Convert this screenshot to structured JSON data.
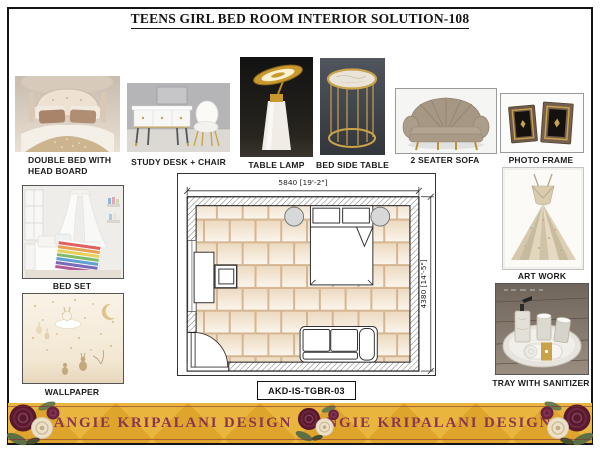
{
  "title": "TEENS GIRL BED ROOM INTERIOR SOLUTION-108",
  "products": {
    "double_bed": {
      "label_line1": "DOUBLE BED WITH",
      "label_line2": "HEAD BOARD"
    },
    "study_desk": {
      "label": "STUDY DESK + CHAIR"
    },
    "table_lamp": {
      "label": "TABLE LAMP"
    },
    "bed_side_table": {
      "label": "BED SIDE TABLE"
    },
    "two_seater_sofa": {
      "label": "2 SEATER SOFA"
    },
    "photo_frame": {
      "label": "PHOTO FRAME"
    },
    "bed_set": {
      "label": "BED SET"
    },
    "wallpaper": {
      "label": "WALLPAPER"
    },
    "art_work": {
      "label": "ART WORK"
    },
    "tray": {
      "label": "TRAY WITH SANITIZER"
    }
  },
  "floor_plan": {
    "width_dimension": "5840 [19'-2\"]",
    "height_dimension": "4380 [14'-5\"]",
    "drawing_code": "AKD-IS-TGBR-03"
  },
  "banner": {
    "brand": "ANGIE KRIPALANI DESIGN",
    "background_color": "#DFA42C",
    "text_color": "#8C3550"
  },
  "colors": {
    "gold_accent": "#C9A24A",
    "page_border": "#141414",
    "floor_tile": "#F2E4D2"
  }
}
